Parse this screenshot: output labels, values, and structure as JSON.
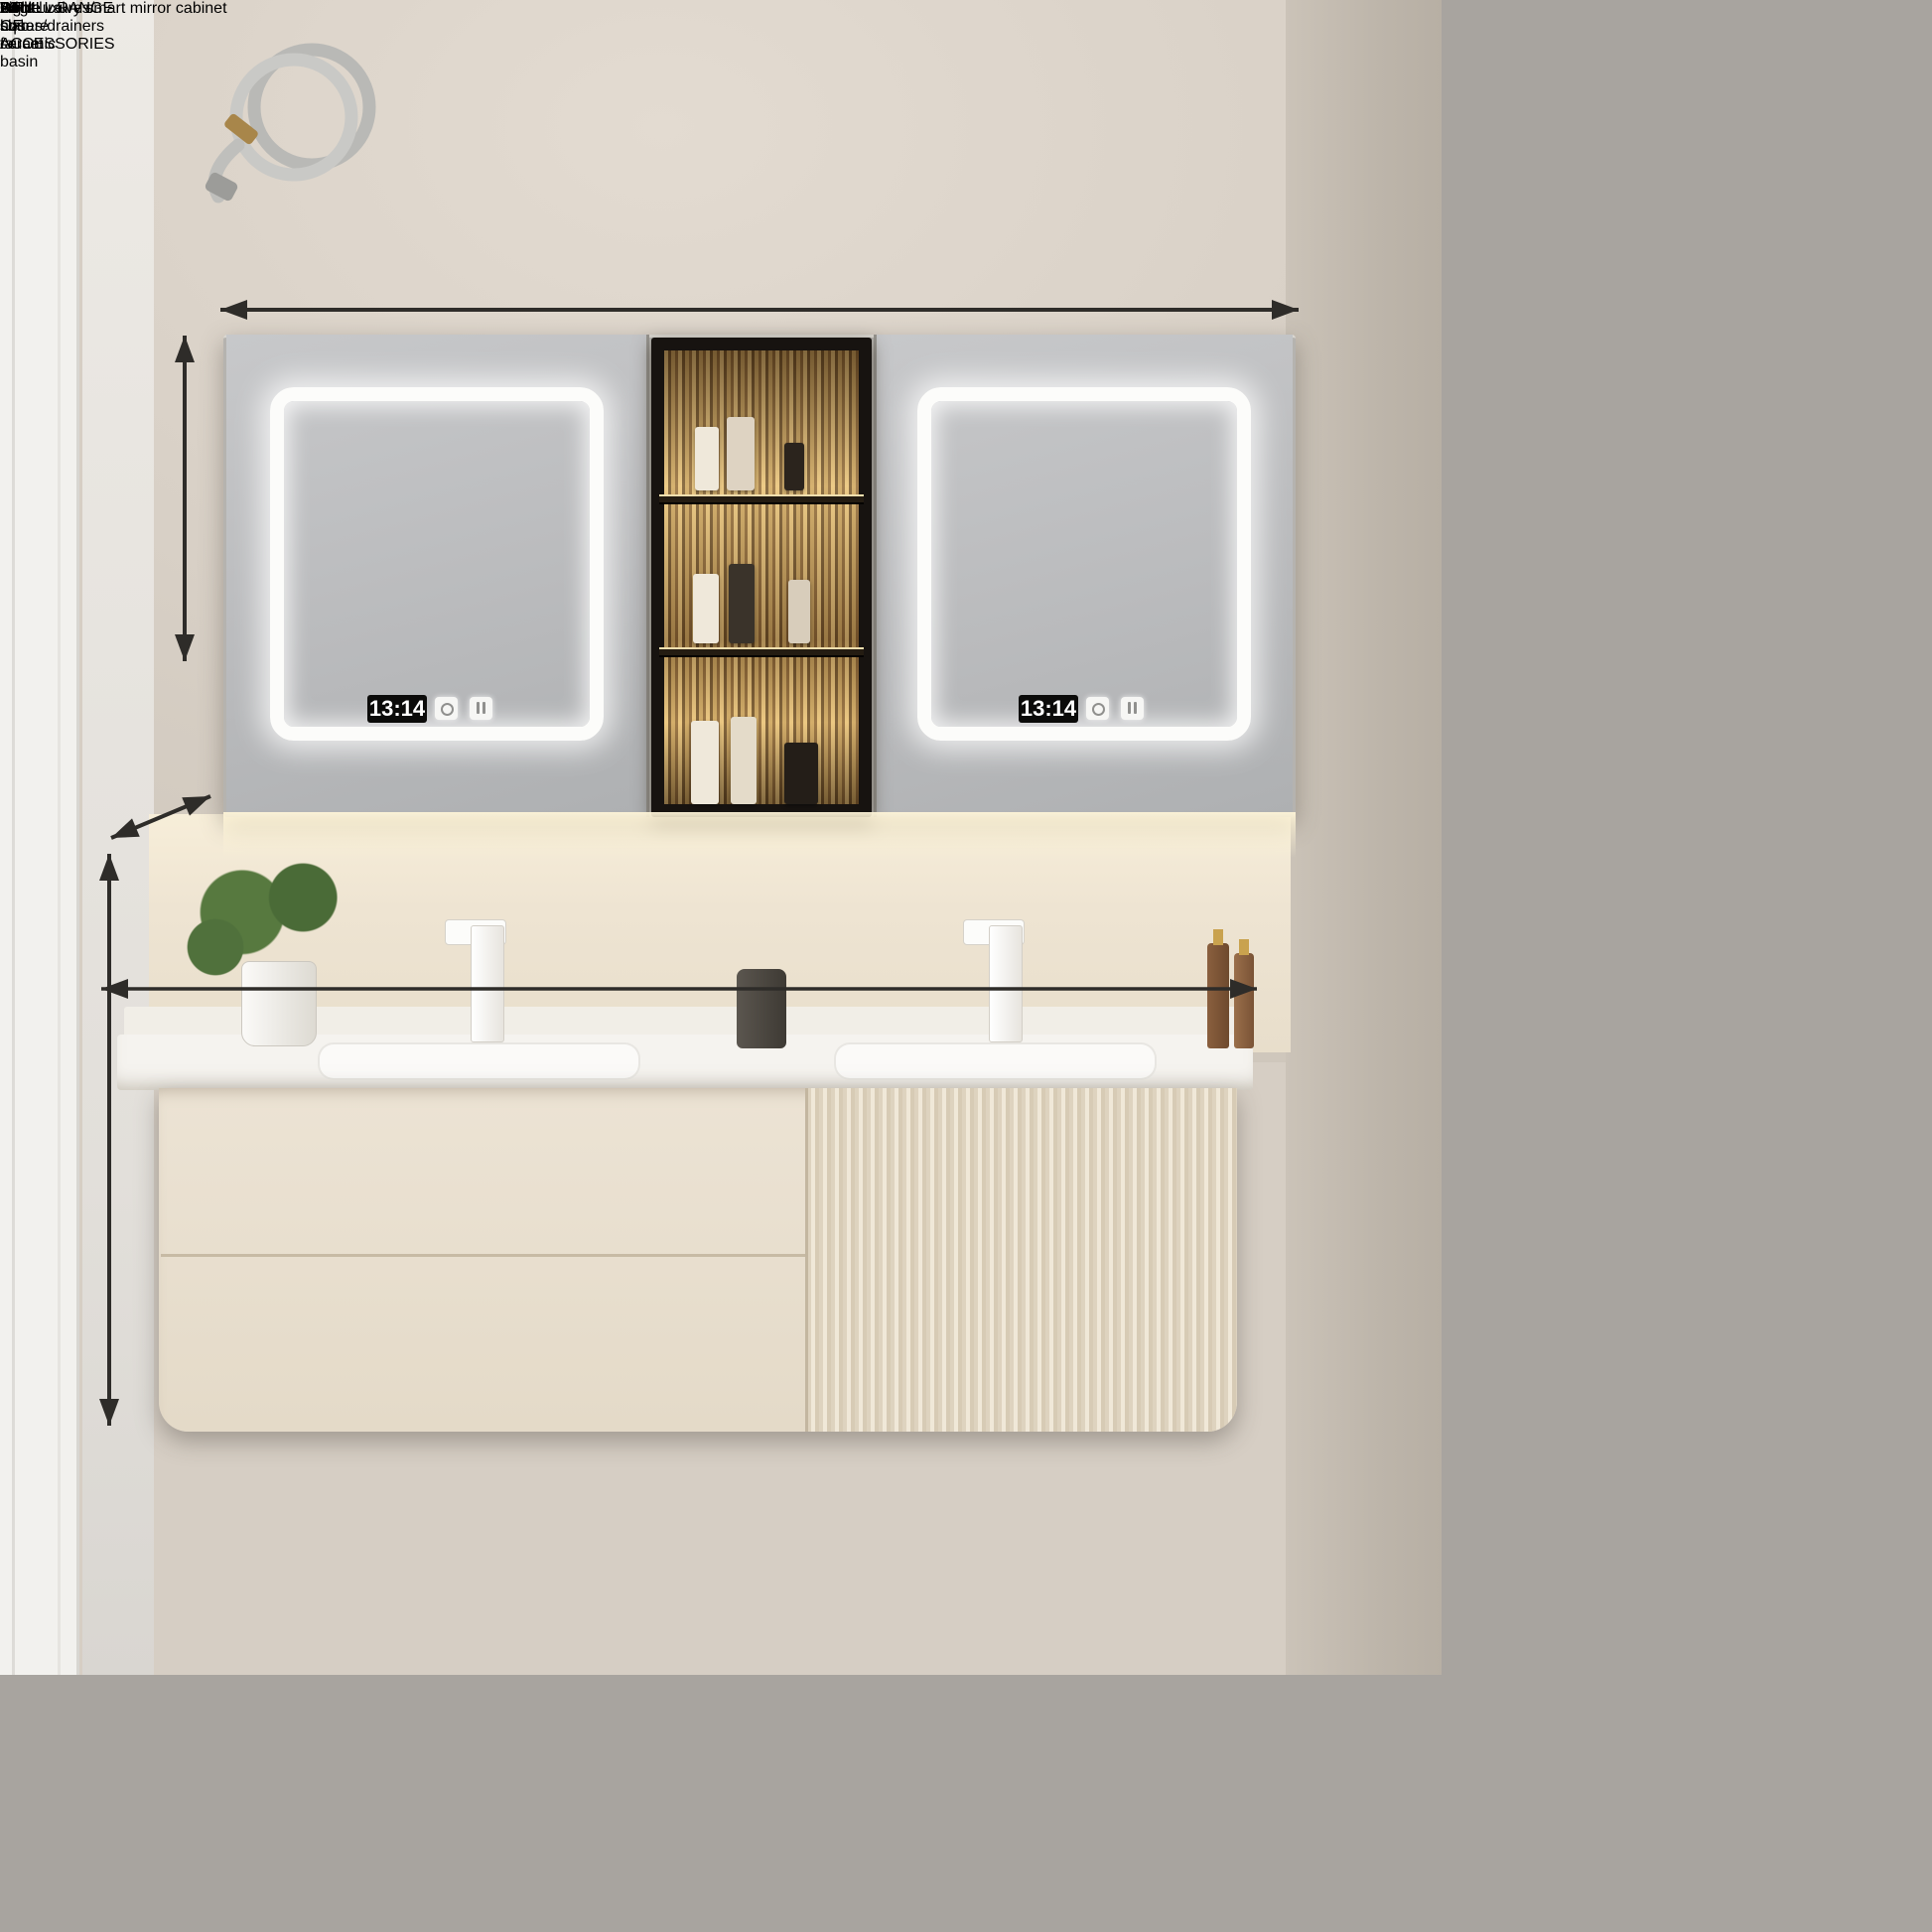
{
  "headline": {
    "size": "64\"",
    "title": "Light luxury smart mirror cabinet"
  },
  "annotations": {
    "cabinet_width": "61\"",
    "cabinet_height": "26\"",
    "counter_depth": "20\"",
    "vanity_height": "20\"",
    "counter_width": "64\""
  },
  "mirror": {
    "clock_time": "13:14"
  },
  "sidebar": {
    "heading": [
      "A FULL RANGE OF",
      "ACCESSORIES"
    ],
    "cards": [
      {
        "id": "white-square-faucet",
        "label": [
          "White square",
          "faucet"
        ]
      },
      {
        "id": "angle-valves-hoses-drainers",
        "label": [
          "Angle valves/",
          "hoses/drainers"
        ]
      },
      {
        "id": "rock-slab-ceramic-basin",
        "label": [
          "Rock slab",
          "ceramic basin"
        ]
      }
    ]
  },
  "colors": {
    "sidebar_bg": "#a8a49f",
    "band_bg": "#000000",
    "text_light": "#ffffff",
    "annotation_text": "#2e2c29",
    "wall": "#d8d0c6",
    "vanity": "#e9e0d1",
    "counter": "#f5f3ef",
    "warm_glow": "#f8ecd2",
    "valve_red_cap": "#b8442f",
    "valve_blue_cap": "#3556a8"
  }
}
